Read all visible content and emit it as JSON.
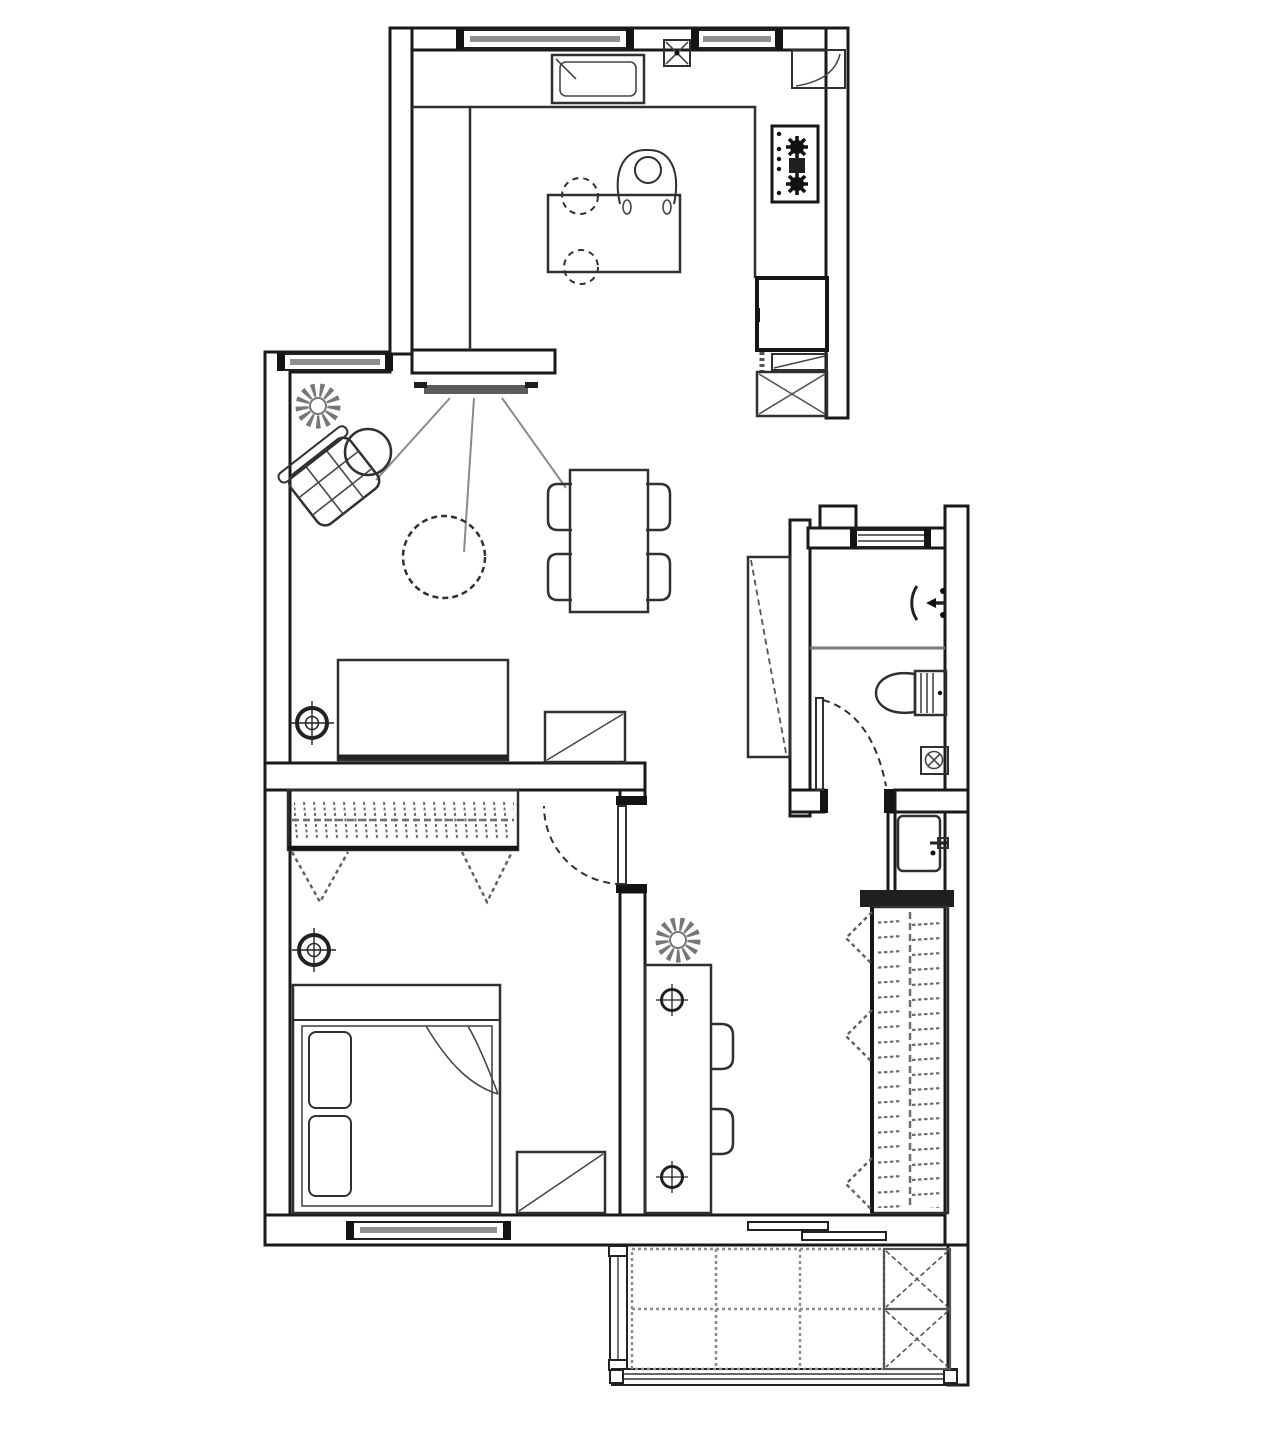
{
  "title": "Apartment floor plan (top view, black and white architectural drawing, no text labels)",
  "canvas": {
    "width_px": 1280,
    "height_px": 1430,
    "background": "#ffffff"
  },
  "style": {
    "wall_color": "#1a1a1a",
    "furniture_color": "#303030",
    "symbol_gray": "#6e6e6e",
    "glass_gray": "#8f8f8f",
    "dark_fill": "#1f1f1f"
  },
  "rooms": [
    {
      "name": "kitchen",
      "aria": "Kitchen: top block with two windows, sink, wall service box, corner shelf, two-burner gas cooktop, L-shaped counter, small table with seated person and two dashed stools, refrigerator, drawer unit and crossed washing-machine box",
      "fixture_counts": {
        "windows": 2,
        "cooktop_burners": 2,
        "stools_dashed": 2,
        "appliance_boxes": 3
      }
    },
    {
      "name": "living-room",
      "aria": "Living room: window on left wall, wall-mounted TV with viewing-angle lines, plant, rotated armchair with round ottoman, dashed round coffee table, dining table with four chairs, sofa against lower wall, side table with diagonal, ceiling light symbol",
      "fixture_counts": {
        "dining_chairs": 4,
        "plants": 1,
        "ceiling_lights": 1
      }
    },
    {
      "name": "bedroom",
      "aria": "Bedroom: built-in wardrobe with hanger hatching and two dashed V clothes symbols, ceiling light, double bed with two pillows and folded blanket corner, nightstand with diagonal, swing door with dashed arc, window in bottom wall",
      "fixture_counts": {
        "pillows": 2,
        "hanging_symbols": 2,
        "ceiling_lights": 1
      }
    },
    {
      "name": "bathroom",
      "aria": "Bathroom: stepped outline with top window, shower zone with shower-head arrow symbol, gray partition line, toilet with cistern, floor drain, swing door with dashed arc, tall dashed-diagonal cabinet outside left wall, washbasin niche with tap below",
      "fixture_counts": {
        "windows": 1,
        "floor_drains": 1
      }
    },
    {
      "name": "hallway",
      "aria": "Hallway / work nook: plant, long desk against bedroom wall, two chairs on the right, two small ceiling light symbols",
      "fixture_counts": {
        "chairs": 2,
        "ceiling_lights": 2,
        "plants": 1
      }
    },
    {
      "name": "wardrobe-closet",
      "aria": "Closet on right side: dark header panel, cabinet with vertical clothes rail and hanger hatching, three dashed triangle door-swing symbols",
      "fixture_counts": {
        "door_swing_triangles": 3
      }
    },
    {
      "name": "balcony",
      "aria": "Balcony at bottom: dashed floor tile grid of three columns by two rows, two crossed storage boxes, glazed left frame and bottom railing, sliding access door in wall",
      "fixture_counts": {
        "tile_columns": 3,
        "tile_rows": 2,
        "storage_boxes": 2
      }
    }
  ]
}
